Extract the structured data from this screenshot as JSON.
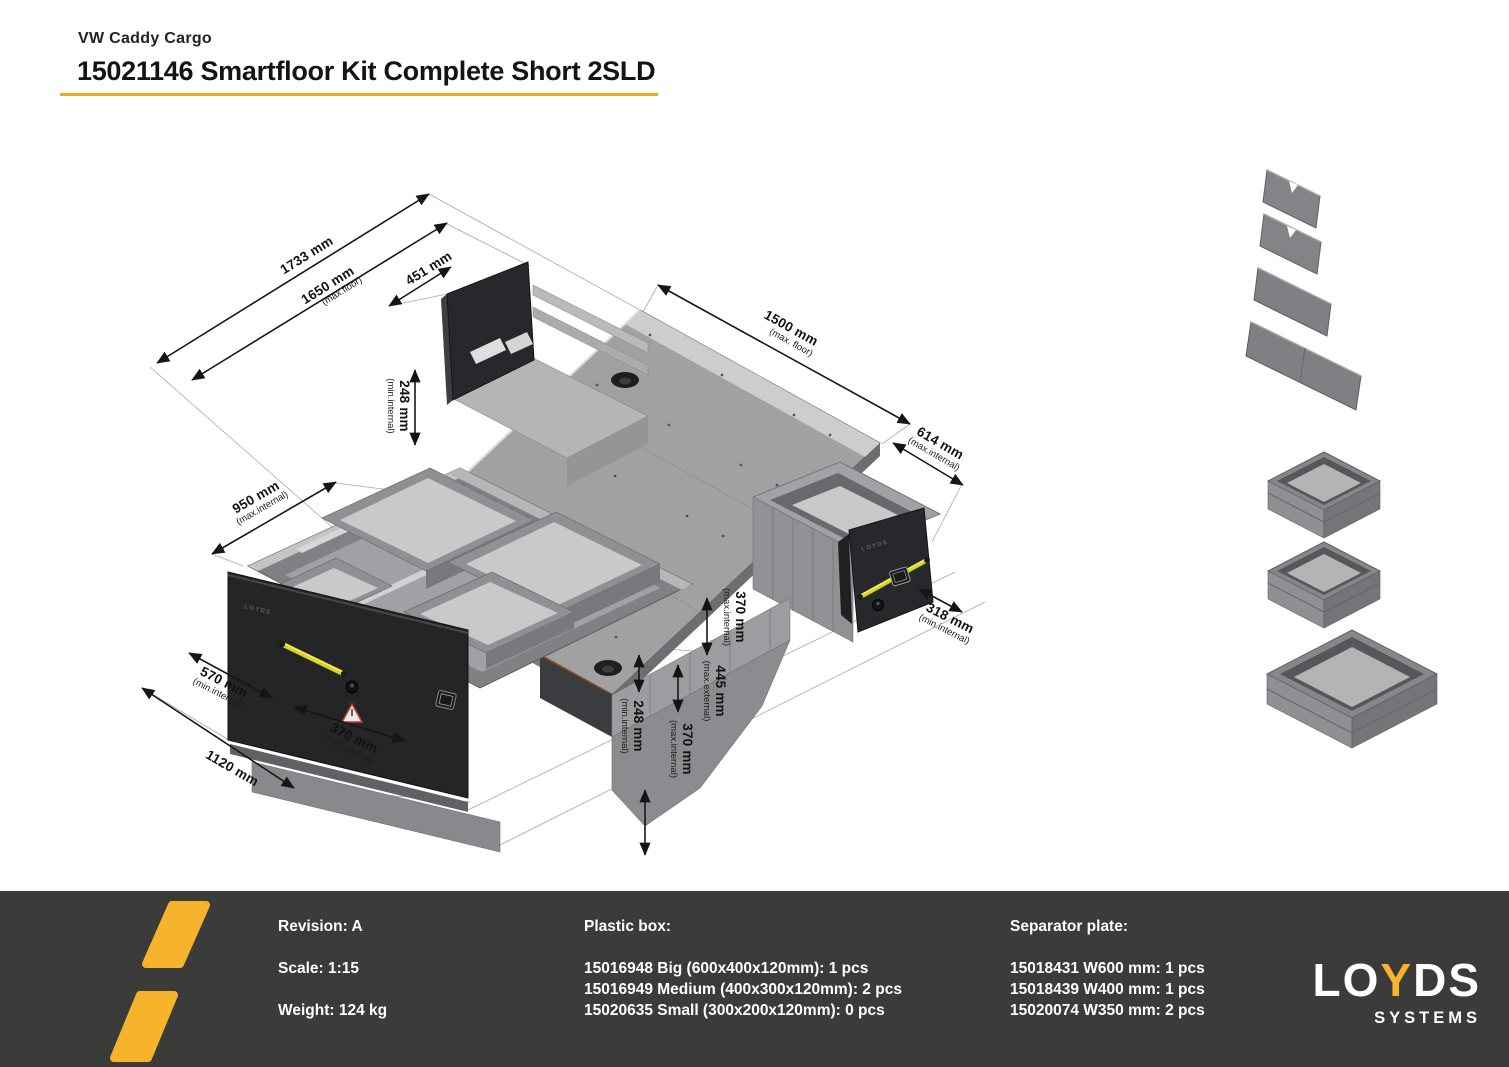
{
  "header": {
    "vehicle_label": "VW Caddy Cargo",
    "title": "15021146 Smartfloor Kit Complete Short 2SLD"
  },
  "colors": {
    "accent_yellow": "#F2A71B",
    "footer_bg": "#3B3B39",
    "logo_yellow": "#F6B32B",
    "handle_yellow": "#D8D51F"
  },
  "drawing": {
    "drawer_brand": "LOYDS",
    "dims": {
      "d1733": {
        "v": "1733 mm",
        "q": ""
      },
      "d1650": {
        "v": "1650 mm",
        "q": "(max.floor)"
      },
      "d451": {
        "v": "451 mm",
        "q": ""
      },
      "d248l": {
        "v": "248 mm",
        "q": "(min.internal)"
      },
      "d1500": {
        "v": "1500 mm",
        "q": "(max. floor)"
      },
      "d614": {
        "v": "614 mm",
        "q": "(max.internal)"
      },
      "d950": {
        "v": "950 mm",
        "q": "(max.internal)"
      },
      "d570": {
        "v": "570 mm",
        "q": "(min.internal)"
      },
      "d370f": {
        "v": "370 mm",
        "q": "(min.internal)"
      },
      "d1120": {
        "v": "1120 mm",
        "q": ""
      },
      "d370t": {
        "v": "370 mm",
        "q": "(max.internal)"
      },
      "d445": {
        "v": "445 mm",
        "q": "(max.external)"
      },
      "d248c": {
        "v": "248 mm",
        "q": "(min.internal)"
      },
      "d370b": {
        "v": "370 mm",
        "q": "(max.internal)"
      },
      "d318": {
        "v": "318 mm",
        "q": "(min.internal)"
      }
    }
  },
  "parts_panel": {
    "separator_plates": [
      "W350",
      "W350",
      "W400",
      "W600"
    ],
    "plastic_boxes": [
      "Medium",
      "Medium",
      "Big"
    ]
  },
  "footer": {
    "info": {
      "revision": "Revision: A",
      "scale": "Scale: 1:15",
      "weight": "Weight: 124 kg"
    },
    "plastic_box": {
      "heading": "Plastic box:",
      "items": [
        "15016948 Big (600x400x120mm): 1 pcs",
        "15016949 Medium (400x300x120mm): 2 pcs",
        "15020635 Small (300x200x120mm): 0 pcs"
      ]
    },
    "separator_plate": {
      "heading": "Separator plate:",
      "items": [
        "15018431 W600 mm: 1 pcs",
        "15018439 W400 mm: 1 pcs",
        "15020074 W350 mm: 2 pcs"
      ]
    },
    "logo": {
      "lo": "LO",
      "y": "Y",
      "ds": "DS",
      "systems": "SYSTEMS"
    }
  }
}
